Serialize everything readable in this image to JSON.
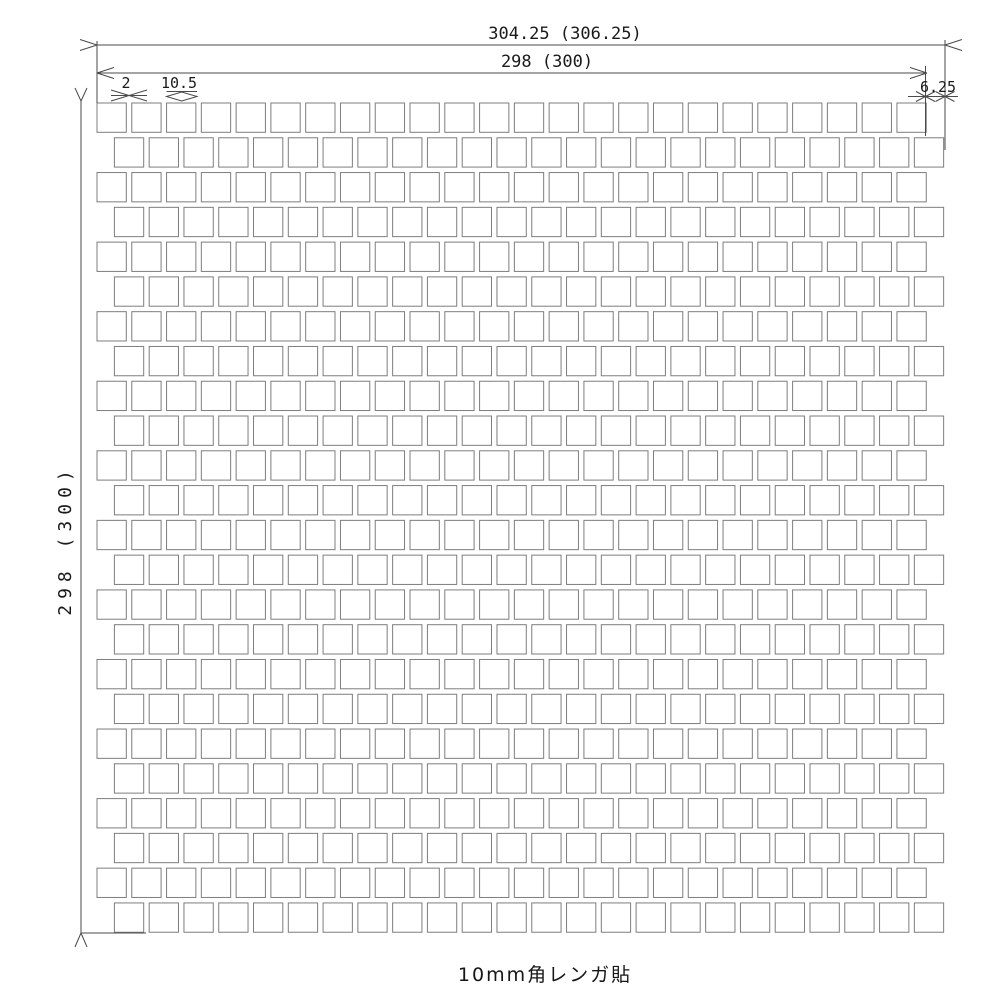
{
  "caption": "10mm角レンガ貼",
  "dimensions": {
    "overall_width": "304.25 (306.25)",
    "sheet_width": "298 (300)",
    "sheet_height": "298 (300)",
    "joint_width": "2",
    "tile_pitch": "10.5",
    "row_offset": "6.25"
  },
  "grid": {
    "rows": 24,
    "columns": 24,
    "tile_size_px": 29.3,
    "pitch_px": 34.78,
    "origin_x": 97,
    "origin_y": 103,
    "offset_row_shift_px": 17.4
  },
  "colors": {
    "background": "#ffffff",
    "tile_outline": "#7d7d7d",
    "dimension_line": "#4a4a4a",
    "text": "#1a1a1a"
  }
}
